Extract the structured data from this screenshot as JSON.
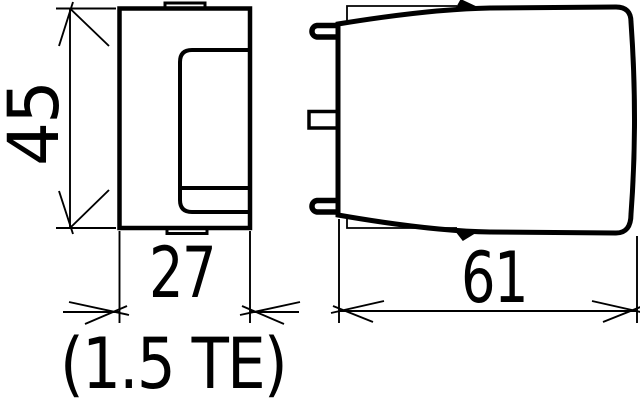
{
  "drawing": {
    "type": "technical-dimension-drawing",
    "background_color": "#ffffff",
    "line_color": "#000000",
    "views": {
      "front_view_name": "front-view",
      "side_view_name": "side-view"
    },
    "labels": {
      "height_mm": "45",
      "width_mm": "27",
      "width_te": "(1.5 TE)",
      "depth_mm": "61"
    }
  }
}
